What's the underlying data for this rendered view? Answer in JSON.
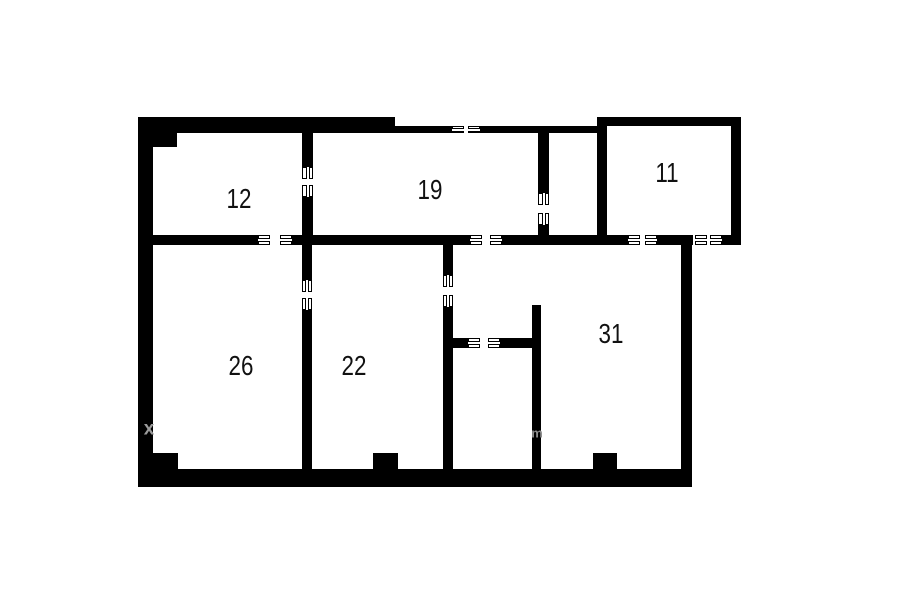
{
  "canvas": {
    "width": 900,
    "height": 604,
    "background": "#ffffff",
    "wall_color": "#000000",
    "label_color": "#111111"
  },
  "plan_type": "apartment-floor-plan",
  "rooms": [
    {
      "label": "12",
      "cx": 239,
      "cy": 199
    },
    {
      "label": "19",
      "cx": 430,
      "cy": 190
    },
    {
      "label": "11",
      "cx": 667,
      "cy": 173
    },
    {
      "label": "26",
      "cx": 241,
      "cy": 366
    },
    {
      "label": "22",
      "cx": 354,
      "cy": 366
    },
    {
      "label": "31",
      "cx": 611,
      "cy": 334
    }
  ],
  "walls": [
    {
      "name": "outer-left-wall",
      "x": 138,
      "y": 117,
      "w": 15,
      "h": 370
    },
    {
      "name": "outer-top-wall-thick",
      "x": 138,
      "y": 117,
      "w": 257,
      "h": 16
    },
    {
      "name": "outer-top-wall-thin-a",
      "x": 395,
      "y": 126,
      "w": 57,
      "h": 7
    },
    {
      "name": "outer-top-wall-thin-b",
      "x": 480,
      "y": 126,
      "w": 127,
      "h": 7
    },
    {
      "name": "outer-bottom-wall",
      "x": 138,
      "y": 469,
      "w": 554,
      "h": 18
    },
    {
      "name": "outer-right-wall",
      "x": 681,
      "y": 245,
      "w": 11,
      "h": 230
    },
    {
      "name": "room11-top-wall",
      "x": 597,
      "y": 117,
      "w": 144,
      "h": 9
    },
    {
      "name": "room11-left-wall",
      "x": 597,
      "y": 117,
      "w": 10,
      "h": 128
    },
    {
      "name": "room11-right-wall",
      "x": 731,
      "y": 117,
      "w": 10,
      "h": 128
    },
    {
      "name": "mid-wall-seg-1",
      "x": 153,
      "y": 235,
      "w": 105,
      "h": 10
    },
    {
      "name": "mid-wall-seg-2",
      "x": 292,
      "y": 235,
      "w": 178,
      "h": 10
    },
    {
      "name": "mid-wall-seg-3",
      "x": 502,
      "y": 235,
      "w": 126,
      "h": 10
    },
    {
      "name": "mid-wall-seg-4",
      "x": 657,
      "y": 235,
      "w": 36,
      "h": 10
    },
    {
      "name": "mid-wall-seg-5",
      "x": 722,
      "y": 235,
      "w": 19,
      "h": 10
    },
    {
      "name": "wall-12-19-upper",
      "x": 302,
      "y": 131,
      "w": 11,
      "h": 36
    },
    {
      "name": "wall-12-19-lower",
      "x": 302,
      "y": 197,
      "w": 11,
      "h": 38
    },
    {
      "name": "wall-26-22-upper",
      "x": 302,
      "y": 245,
      "w": 10,
      "h": 35
    },
    {
      "name": "wall-26-22-lower",
      "x": 302,
      "y": 310,
      "w": 10,
      "h": 159
    },
    {
      "name": "wall-19-closet-upper",
      "x": 538,
      "y": 133,
      "w": 11,
      "h": 60
    },
    {
      "name": "wall-19-closet-lower",
      "x": 538,
      "y": 225,
      "w": 11,
      "h": 10
    },
    {
      "name": "wall-22-corridor-upper",
      "x": 443,
      "y": 245,
      "w": 10,
      "h": 30
    },
    {
      "name": "wall-22-corridor-lower",
      "x": 443,
      "y": 307,
      "w": 10,
      "h": 162
    },
    {
      "name": "bath-wall-stub-left",
      "x": 453,
      "y": 338,
      "w": 15,
      "h": 10
    },
    {
      "name": "bath-wall-stub-right",
      "x": 500,
      "y": 338,
      "w": 33,
      "h": 10
    },
    {
      "name": "wall-31-bath",
      "x": 532,
      "y": 305,
      "w": 9,
      "h": 164
    },
    {
      "name": "pier-top-left",
      "x": 153,
      "y": 131,
      "w": 24,
      "h": 16
    },
    {
      "name": "pier-bottom-left",
      "x": 153,
      "y": 453,
      "w": 25,
      "h": 16
    },
    {
      "name": "pier-bottom-mid",
      "x": 373,
      "y": 453,
      "w": 25,
      "h": 16
    },
    {
      "name": "pier-bottom-right",
      "x": 593,
      "y": 453,
      "w": 24,
      "h": 16
    }
  ],
  "doors": [
    {
      "name": "opening-top-wall",
      "x": 452,
      "y": 126,
      "w": 28,
      "h": 7,
      "dir": "h"
    },
    {
      "name": "door-12-26",
      "x": 258,
      "y": 235,
      "w": 34,
      "h": 10,
      "dir": "h"
    },
    {
      "name": "door-19-corridor",
      "x": 470,
      "y": 235,
      "w": 32,
      "h": 10,
      "dir": "h"
    },
    {
      "name": "door-11-31-left",
      "x": 628,
      "y": 235,
      "w": 29,
      "h": 10,
      "dir": "h"
    },
    {
      "name": "door-11-right",
      "x": 695,
      "y": 235,
      "w": 27,
      "h": 10,
      "dir": "h"
    },
    {
      "name": "door-12-19",
      "x": 302,
      "y": 167,
      "w": 11,
      "h": 30,
      "dir": "v"
    },
    {
      "name": "door-26-22",
      "x": 302,
      "y": 280,
      "w": 10,
      "h": 30,
      "dir": "v"
    },
    {
      "name": "door-22-corridor",
      "x": 443,
      "y": 275,
      "w": 10,
      "h": 32,
      "dir": "v"
    },
    {
      "name": "door-19-closet",
      "x": 538,
      "y": 193,
      "w": 11,
      "h": 32,
      "dir": "v"
    },
    {
      "name": "door-bath",
      "x": 468,
      "y": 338,
      "w": 32,
      "h": 10,
      "dir": "h"
    }
  ],
  "watermarks": [
    {
      "char": "x",
      "x": 149,
      "y": 429,
      "size": 19,
      "color": "#9b9b9b"
    },
    {
      "char": "m",
      "x": 537,
      "y": 433,
      "size": 13,
      "color": "#8f8f8f"
    }
  ]
}
